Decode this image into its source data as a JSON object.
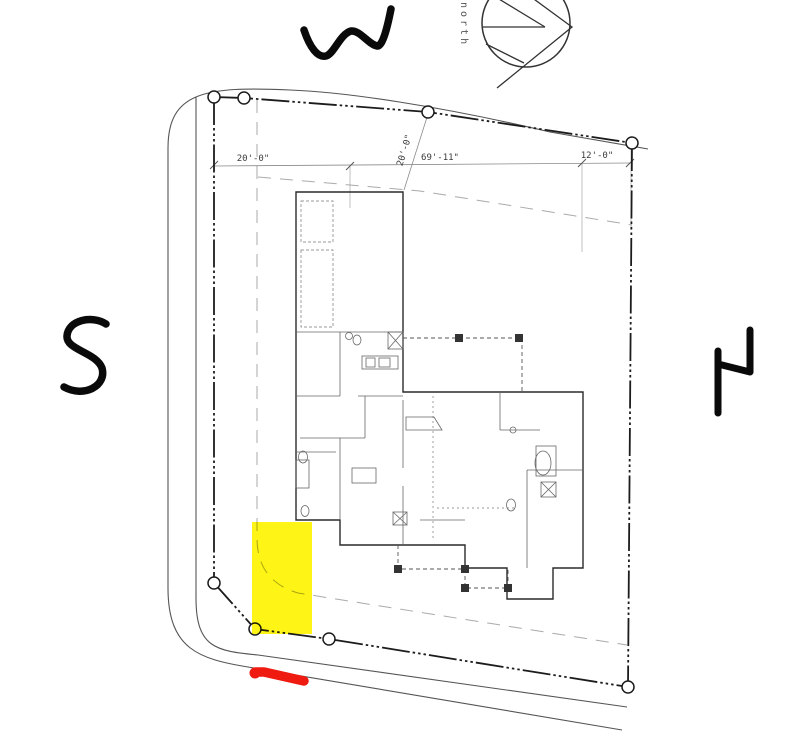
{
  "title": "hand-annotated residential site plan",
  "compass": {
    "label": "north"
  },
  "dimensions": {
    "left": "20'-0\"",
    "diagonal": "20'-0\"",
    "middle": "69'-11\"",
    "right": "12'-0\""
  },
  "hand_annotations": {
    "top_letter": "W",
    "left_letter": "S",
    "right_letter": "N",
    "ink_color": "#0a0a0a",
    "highlight_color": "#fef502",
    "marker_color": "#ef1a10"
  },
  "drawing": {
    "line_color": "#1c1c1c",
    "road_color": "#555555",
    "setback_color": "#aaaaaa",
    "survey_markers": 8
  }
}
